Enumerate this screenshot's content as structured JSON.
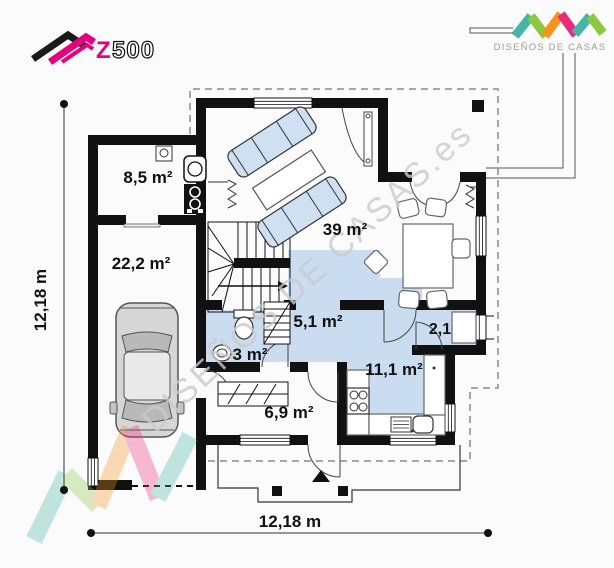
{
  "branding": {
    "z500": {
      "z": "Z",
      "five_hundred": "500"
    },
    "disenos": {
      "text": "DISEÑOS DE CASAS"
    },
    "colors": {
      "magenta": "#e6007e",
      "teal": "#45b5a9",
      "green": "#8dc63f",
      "orange": "#f7941e",
      "pink": "#ec2a7c"
    }
  },
  "watermark": {
    "diagonal_text": "DISEÑOS DE CASAS.es"
  },
  "plan": {
    "rooms": {
      "utility": "8,5 m²",
      "garage": "22,2 m²",
      "living": "39 m²",
      "hall": "5,1 m²",
      "pantry": "2,1",
      "bathroom": "3 m²",
      "kitchen": "11,1 m²",
      "vestibule": "6,9 m²"
    },
    "dimensions": {
      "horizontal": "12,18 m",
      "vertical": "12,18 m"
    },
    "floor_accent_color": "#c9dcf0"
  }
}
